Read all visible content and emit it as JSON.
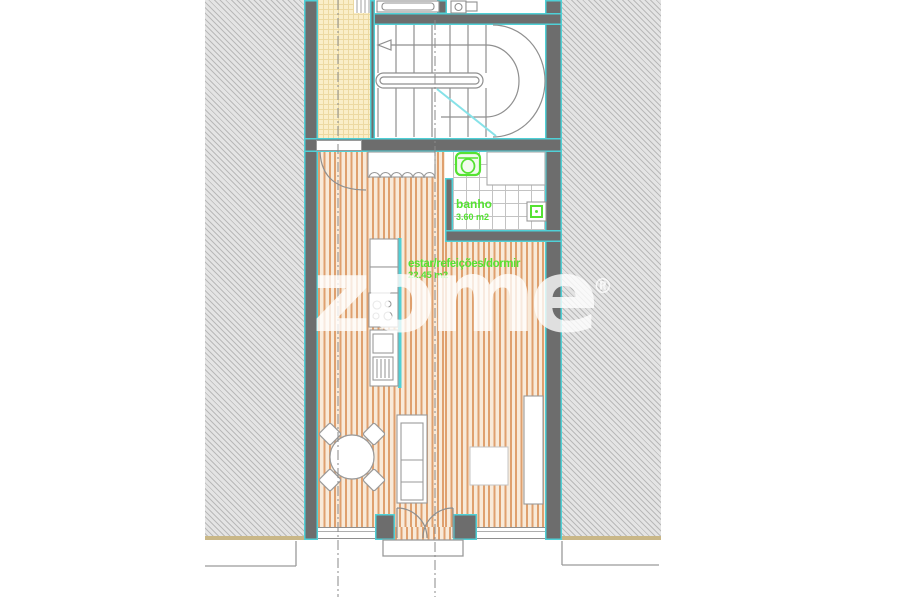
{
  "document": {
    "type": "architectural-floor-plan",
    "style": "CAD drawing"
  },
  "rooms": {
    "bathroom": {
      "label": "banho",
      "area": "3.60 m2"
    },
    "living": {
      "label": "estar/refeições/dormir",
      "area": "22.45 m2"
    }
  },
  "watermark": {
    "text": "zome",
    "reg": "®"
  },
  "palette": {
    "wall_fill": "#6d6d6d",
    "wall_face": "#4fd0d6",
    "label_green": "#55e232",
    "wood_stripe": "#dfa06e",
    "wood_base": "#f8ead9",
    "patio_yellow": "#faeec8",
    "hatch_grey": "#b9b9b9",
    "ground_sand": "#c9b787",
    "section_cyan": "#86e2e8"
  }
}
